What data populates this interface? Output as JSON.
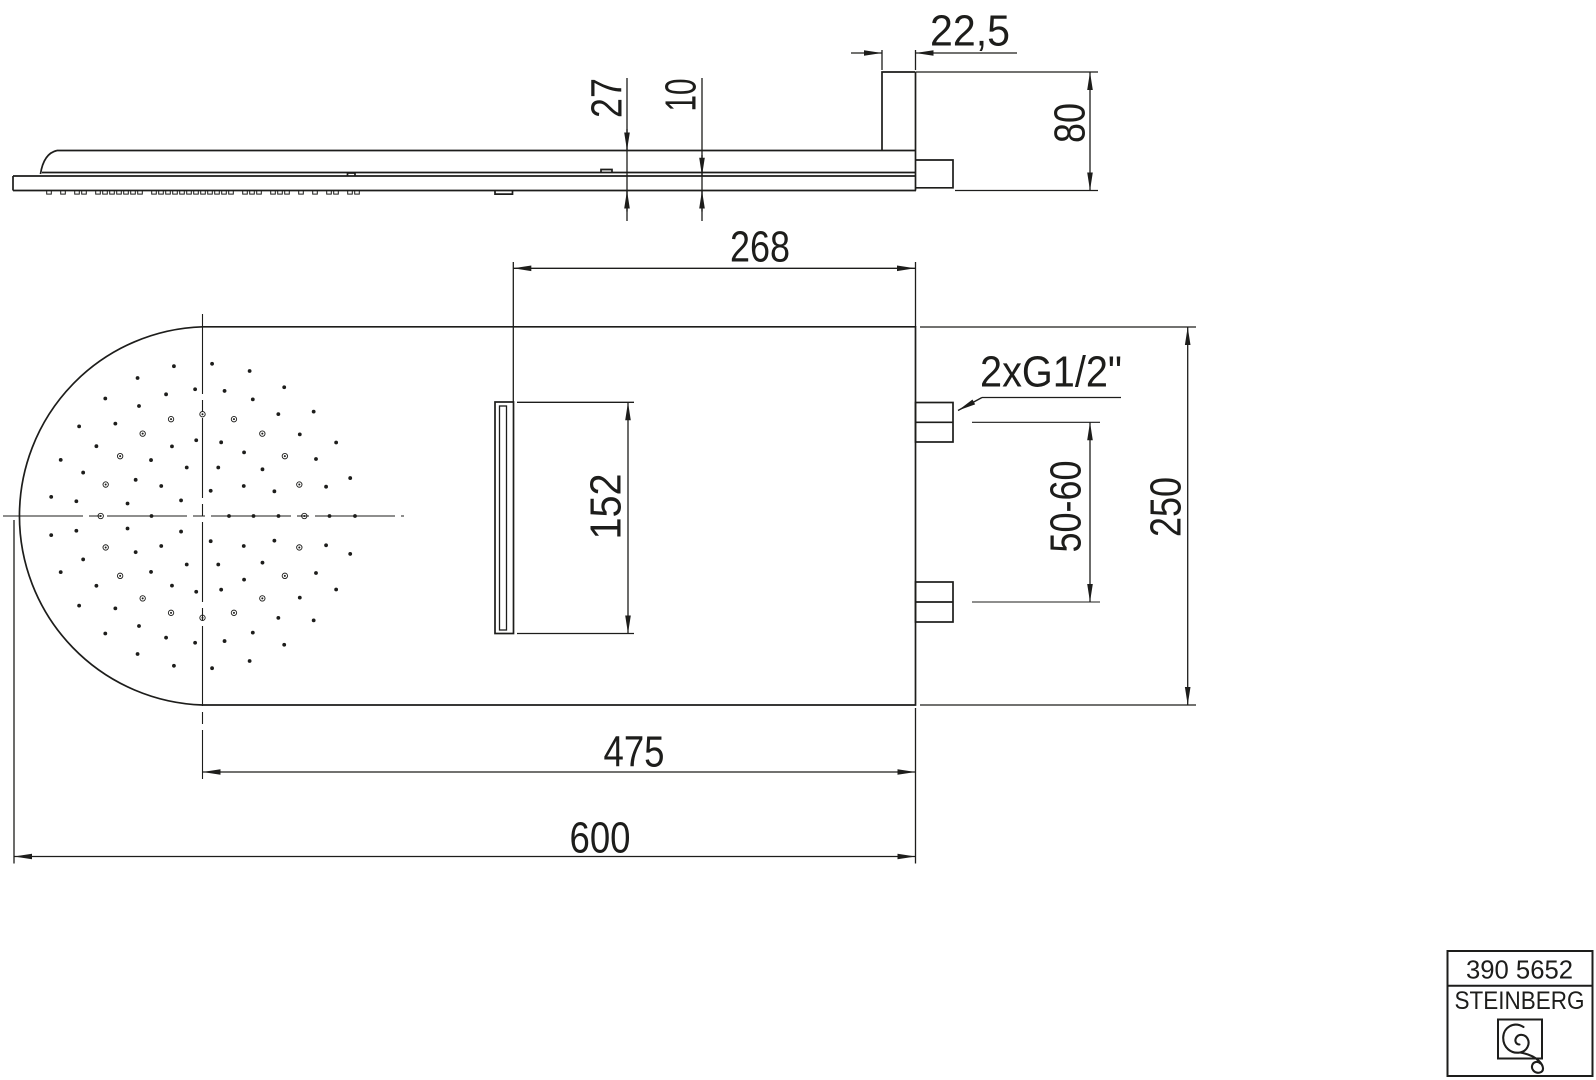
{
  "page": {
    "width": 1596,
    "height": 1080,
    "ink": "#1d1d1b",
    "paper": "#ffffff"
  },
  "drawing": {
    "type": "technical-dimension-drawing",
    "product": "rain shower head with wall bracket",
    "views": [
      "side-profile-view",
      "front-face-view"
    ]
  },
  "dimensions": {
    "bracket_depth": {
      "text": "22,5",
      "orientation": "horizontal"
    },
    "head_thickness": {
      "text": "27",
      "orientation": "vertical"
    },
    "plate_thickness": {
      "text": "10",
      "orientation": "vertical"
    },
    "bracket_height": {
      "text": "80",
      "orientation": "vertical"
    },
    "outlet_to_edge": {
      "text": "268",
      "orientation": "horizontal"
    },
    "outlet_length": {
      "text": "152",
      "orientation": "vertical"
    },
    "connection_thread": {
      "text": "2xG1/2\"",
      "orientation": "horizontal"
    },
    "connection_spacing": {
      "text": "50-60",
      "orientation": "vertical"
    },
    "body_width": {
      "text": "250",
      "orientation": "vertical"
    },
    "spray_center_to_edge": {
      "text": "475",
      "orientation": "horizontal"
    },
    "total_length": {
      "text": "600",
      "orientation": "horizontal"
    }
  },
  "title_block": {
    "article_number": "390 5652",
    "brand": "STEINBERG",
    "logo": "steinberg-swirl-logo"
  },
  "nozzle_pattern": {
    "center_x": 202.5,
    "center_y": 516,
    "dot_radius": 1.9,
    "ringed_outer_radius": 2.7,
    "ringed_dot_radius": 1.0,
    "rings": [
      {
        "radius": 26.5,
        "count": 5,
        "start_deg": 0,
        "style": "plain"
      },
      {
        "radius": 51,
        "count": 10,
        "start_deg": 0,
        "style": "plain"
      },
      {
        "radius": 76,
        "count": 19,
        "start_deg": 0,
        "style": "plain"
      },
      {
        "radius": 101.8,
        "count": 20,
        "start_deg": 0,
        "style": "ringed"
      },
      {
        "radius": 127,
        "count": 27,
        "start_deg": 0,
        "style": "plain"
      },
      {
        "radius": 152.5,
        "count": 25,
        "start_deg": 0,
        "style": "plain"
      }
    ]
  },
  "side_ticks": {
    "y": 190.5,
    "height": 3.6,
    "width": 4.6,
    "grid": 7
  }
}
